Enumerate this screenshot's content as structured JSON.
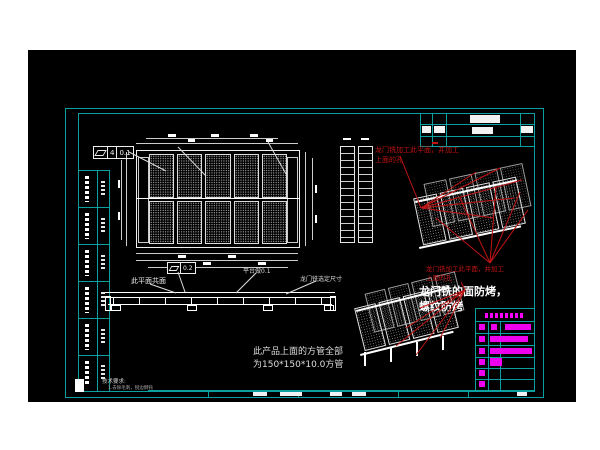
{
  "window": {
    "description": "CAD drawing viewport on white desktop background"
  },
  "colors": {
    "cyan": "#0aa0a0",
    "magenta": "#ee00ee",
    "red": "#c21414",
    "drawing_white": "#ffffff",
    "canvas_bg": "#000000",
    "page_bg": "#ffffff"
  },
  "annotations": {
    "red_machining_note": {
      "line1": "龙门铣加工此平面，并加工",
      "line2": "上面的孔"
    },
    "surface_treatment_note": {
      "line1": "龙门铣的面防烤，",
      "line2": "螺纹防烤"
    },
    "coplanar_label": "此平面共面",
    "platform_flatness_label": "平台做0.1",
    "gantry_mill_size_label": "龙门铣选定尺寸",
    "square_tube_note": {
      "line1": "此产品上面的方管全部",
      "line2": "为150*150*10.0方管"
    },
    "tech_requirements": {
      "title": "技术要求:",
      "item1": "1.去除毛刺，锐边倒钝"
    },
    "gdt_flatness_main": {
      "zone": "4",
      "value": "0.1"
    },
    "gdt_flatness_side": {
      "value": "0.2"
    }
  }
}
